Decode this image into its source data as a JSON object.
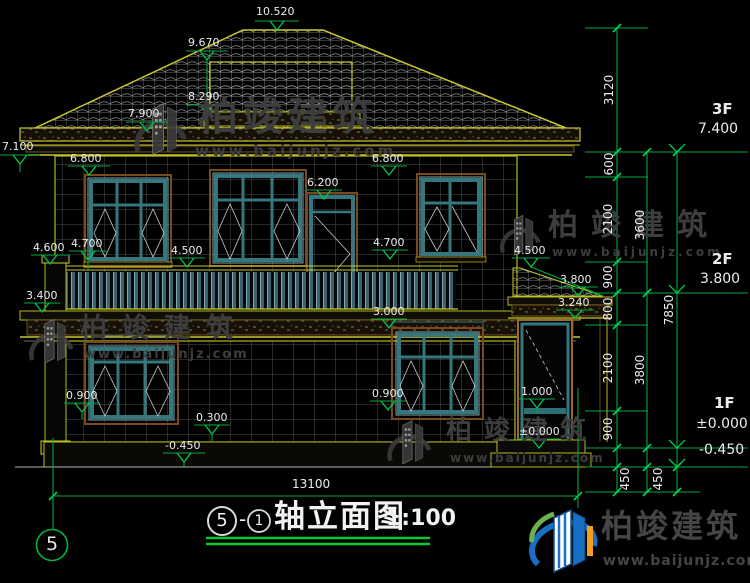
{
  "title": {
    "axis_start": "5",
    "dash": "-",
    "axis_end": "1",
    "name": "轴立面图",
    "scale": "1:100"
  },
  "axis_bubble_label": "5",
  "bottom_dim_total": "13100",
  "elevations": {
    "peak": "10.520",
    "ridge": "9.670",
    "upper_eave": "8.290",
    "eave_top": "7.900",
    "eave_bottom": "7.100",
    "win_top_left": "6.800",
    "door_top": "6.200",
    "win_top_right": "6.800",
    "pilaster_cap": "4.600",
    "sill_left": "4.700",
    "rail_mid": "4.500",
    "sill_right": "4.700",
    "porch_roof_top": "4.500",
    "slab": "3.400",
    "porch_ridge": "3.800",
    "porch_eave": "3.240",
    "f1_win_top": "3.000",
    "f1_sill_left": "0.900",
    "f1_step": "0.300",
    "ground_left": "-0.450",
    "f1_sill_right": "0.900",
    "porch_door_rail": "1.000",
    "porch_floor": "±0.000"
  },
  "levels": {
    "f3_label": "3F",
    "f3_value": "7.400",
    "f2_label": "2F",
    "f2_value": "3.800",
    "f1_label": "1F",
    "f1_value": "±0.000",
    "f1_ground": "-0.450"
  },
  "vdims": {
    "v3120": "3120",
    "v600": "600",
    "v2100a": "2100",
    "v900a": "900",
    "v800": "800",
    "v2100b": "2100",
    "v900b": "900",
    "v450a": "450",
    "v3600": "3600",
    "v3800": "3800",
    "v450b": "450",
    "v7850": "7850"
  },
  "watermark": {
    "brand": "柏竣建筑",
    "url": "www.baijunjz.com"
  },
  "logo": {
    "brand": "柏竣建筑",
    "url": "www.baijunjz.com"
  }
}
